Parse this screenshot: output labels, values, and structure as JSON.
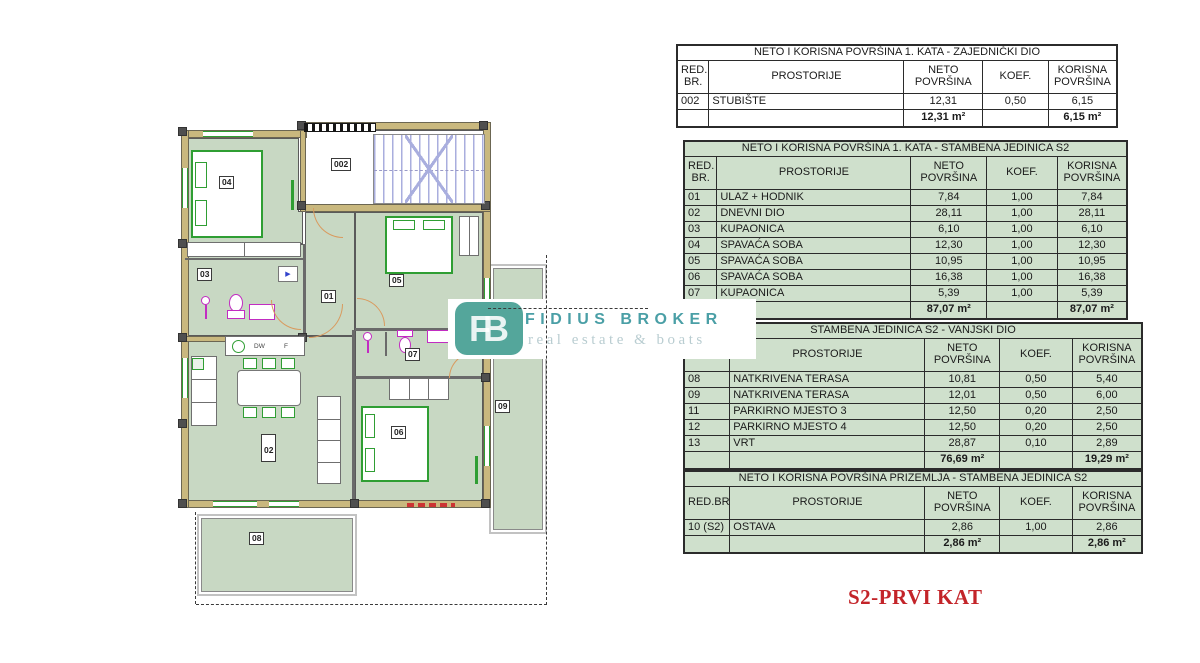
{
  "logo": {
    "badge": "FB",
    "title": "FIDIUS BROKER",
    "subtitle": "real estate & boats"
  },
  "sheet_label": "S2-PRVI KAT",
  "tables": [
    {
      "title": "NETO I KORISNA POVRŠINA 1. KATA - ZAJEDNIČKI DIO",
      "theme": "white",
      "columns": [
        "RED.\nBR.",
        "PROSTORIJE",
        "NETO\nPOVRŠINA",
        "KOEF.",
        "KORISNA\nPOVRŠINA"
      ],
      "rows": [
        [
          "002",
          "STUBIŠTE",
          "12,31",
          "0,50",
          "6,15"
        ]
      ],
      "total_neto": "12,31 m²",
      "total_korisna": "6,15 m²"
    },
    {
      "title": "NETO I KORISNA POVRŠINA 1. KATA - STAMBENA JEDINICA S2",
      "theme": "green",
      "columns": [
        "RED.\nBR.",
        "PROSTORIJE",
        "NETO\nPOVRŠINA",
        "KOEF.",
        "KORISNA\nPOVRŠINA"
      ],
      "rows": [
        [
          "01",
          "ULAZ + HODNIK",
          "7,84",
          "1,00",
          "7,84"
        ],
        [
          "02",
          "DNEVNI DIO",
          "28,11",
          "1,00",
          "28,11"
        ],
        [
          "03",
          "KUPAONICA",
          "6,10",
          "1,00",
          "6,10"
        ],
        [
          "04",
          "SPAVAĆA SOBA",
          "12,30",
          "1,00",
          "12,30"
        ],
        [
          "05",
          "SPAVAĆA SOBA",
          "10,95",
          "1,00",
          "10,95"
        ],
        [
          "06",
          "SPAVAĆA SOBA",
          "16,38",
          "1,00",
          "16,38"
        ],
        [
          "07",
          "KUPAONICA",
          "5,39",
          "1,00",
          "5,39"
        ]
      ],
      "total_neto": "87,07 m²",
      "total_korisna": "87,07 m²"
    },
    {
      "title": "STAMBENA JEDINICA S2 - VANJSKI DIO",
      "theme": "green",
      "columns": [
        "RED.BR.",
        "PROSTORIJE",
        "NETO\nPOVRŠINA",
        "KOEF.",
        "KORISNA\nPOVRŠINA"
      ],
      "rows": [
        [
          "08",
          "NATKRIVENA TERASA",
          "10,81",
          "0,50",
          "5,40"
        ],
        [
          "09",
          "NATKRIVENA TERASA",
          "12,01",
          "0,50",
          "6,00"
        ],
        [
          "11",
          "PARKIRNO MJESTO 3",
          "12,50",
          "0,20",
          "2,50"
        ],
        [
          "12",
          "PARKIRNO MJESTO 4",
          "12,50",
          "0,20",
          "2,50"
        ],
        [
          "13",
          "VRT",
          "28,87",
          "0,10",
          "2,89"
        ]
      ],
      "total_neto": "76,69 m²",
      "total_korisna": "19,29 m²"
    },
    {
      "title": "NETO I KORISNA POVRŠINA PRIZEMLJA - STAMBENA JEDINICA S2",
      "theme": "green",
      "columns": [
        "RED.BR.",
        "PROSTORIJE",
        "NETO\nPOVRŠINA",
        "KOEF.",
        "KORISNA\nPOVRŠINA"
      ],
      "rows": [
        [
          "10 (S2)",
          "OSTAVA",
          "2,86",
          "1,00",
          "2,86"
        ]
      ],
      "total_neto": "2,86 m²",
      "total_korisna": "2,86 m²"
    }
  ],
  "floor_plan": {
    "rooms": [
      {
        "id": "002",
        "label": "002"
      },
      {
        "id": "04",
        "label": "04"
      },
      {
        "id": "03",
        "label": "03"
      },
      {
        "id": "01",
        "label": "01"
      },
      {
        "id": "05",
        "label": "05"
      },
      {
        "id": "02",
        "label": "02"
      },
      {
        "id": "07",
        "label": "07"
      },
      {
        "id": "06",
        "label": "06"
      },
      {
        "id": "09",
        "label": "09"
      },
      {
        "id": "08",
        "label": "08"
      }
    ],
    "kitchen": {
      "dw": "DW",
      "f": "F"
    }
  },
  "colors": {
    "table-green": "#cfe0cc",
    "plan-green": "#c8d8c3",
    "wall-tan": "#c9b87e",
    "furniture-green": "#2f9e33",
    "fixture-magenta": "#c22cc2",
    "stair-blue": "#a9aede",
    "logo-teal": "#54a69b",
    "logo-text": "#4a9fa6",
    "logo-sub": "#b9cdd1",
    "title-red": "#c32429"
  }
}
